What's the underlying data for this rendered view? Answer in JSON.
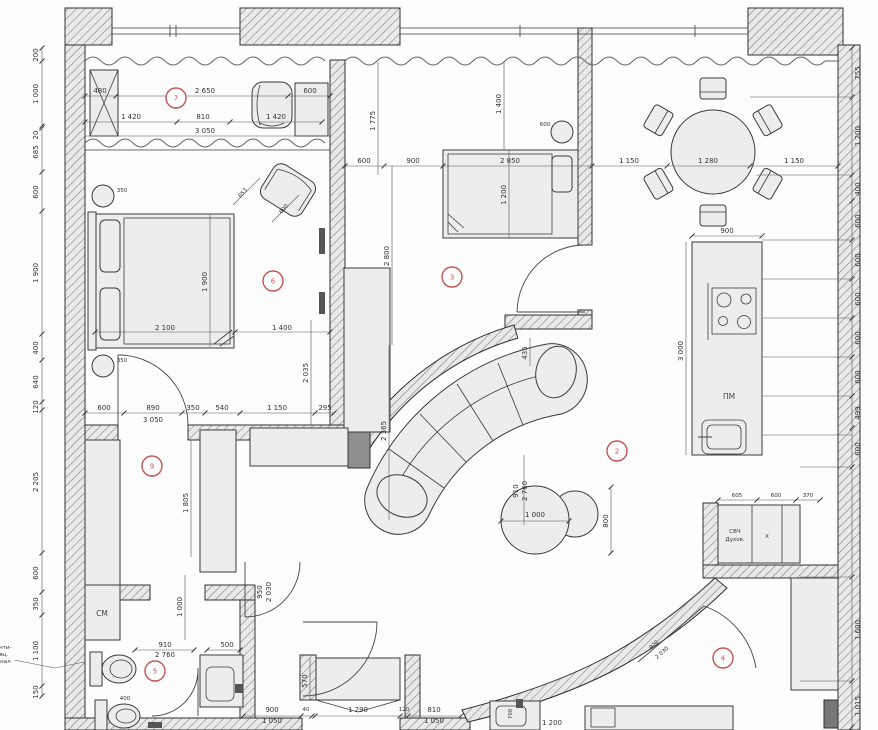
{
  "colors": {
    "red": "#c45252",
    "line": "#3a3a3a",
    "wall_fill": "#e9e9e9",
    "paper": "#fdfdfd"
  },
  "markers": [
    "7",
    "6",
    "3",
    "2",
    "9",
    "5",
    "4"
  ],
  "labels": {
    "washer": "СМ",
    "dishwasher": "ПМ",
    "microwave": "СВЧ",
    "oven": "Духов.",
    "fridge": "X",
    "note": [
      "венти-",
      "ляц.",
      "канал"
    ]
  },
  "dims": {
    "t": [
      "480",
      "2 650",
      "600"
    ],
    "b": [
      "1 420",
      "810",
      "1 420",
      "3 050"
    ],
    "L": [
      "200",
      "1 000",
      "20",
      "685",
      "600",
      "1 900",
      "400",
      "640",
      "120",
      "2 205",
      "600",
      "350",
      "1 100",
      "150"
    ],
    "R": [
      "755",
      "1 200",
      "400",
      "600",
      "600",
      "600",
      "600",
      "600",
      "499",
      "600",
      "1 600",
      "1 015"
    ],
    "room": [
      "600",
      "900",
      "2 850",
      "1 150",
      "1 280",
      "1 150"
    ],
    "bed6": [
      "2 100",
      "1 400",
      "1 900",
      "2 035"
    ],
    "mir": [
      "350",
      "350"
    ],
    "ch": [
      "653",
      "600"
    ],
    "r3": [
      "1 775",
      "1 400",
      "1 200",
      "2 800",
      "435",
      "910",
      "2 760",
      "2 365",
      "600"
    ],
    "hallTop": [
      "600",
      "890",
      "350",
      "540",
      "1 150",
      "295",
      "3 050"
    ],
    "hall": [
      "1 805",
      "1 000",
      "950",
      "2 030"
    ],
    "kit": [
      "900",
      "3 000"
    ],
    "tbl": [
      "1 000",
      "800"
    ],
    "cab": [
      "605",
      "600",
      "370"
    ],
    "door4": [
      "920",
      "2 030"
    ],
    "bath": [
      "910",
      "2 760",
      "500",
      "400"
    ],
    "bot": [
      "900",
      "1 050",
      "40",
      "1 290",
      "120",
      "810",
      "1 050",
      "570",
      "1 200",
      "700"
    ]
  }
}
